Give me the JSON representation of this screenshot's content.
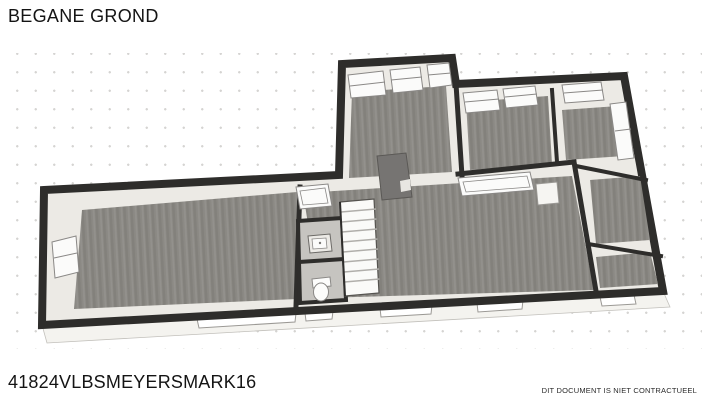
{
  "header": {
    "title": "BEGANE GROND"
  },
  "footer": {
    "reference": "41824VLBSMEYERSMARK16",
    "disclaimer": "DIT DOCUMENT IS NIET CONTRACTUEEL"
  },
  "floorplan": {
    "floor_name": "BEGANE GROND",
    "elements": [
      "staircase",
      "wc-sink",
      "toilet",
      "windows",
      "chimney"
    ]
  },
  "colors": {
    "background": "#ffffff",
    "grid_dot": "#d5d4d2",
    "wall_outline": "#2e2d2b",
    "wall_face": "#eceae5",
    "floor": "#8b8984",
    "wc_floor": "#c6c4c0",
    "window": "#fbfbfa",
    "front_face": "#f4f3ef",
    "chimney": "#767472",
    "fixture": "#fcfcfb",
    "text": "#141414"
  }
}
